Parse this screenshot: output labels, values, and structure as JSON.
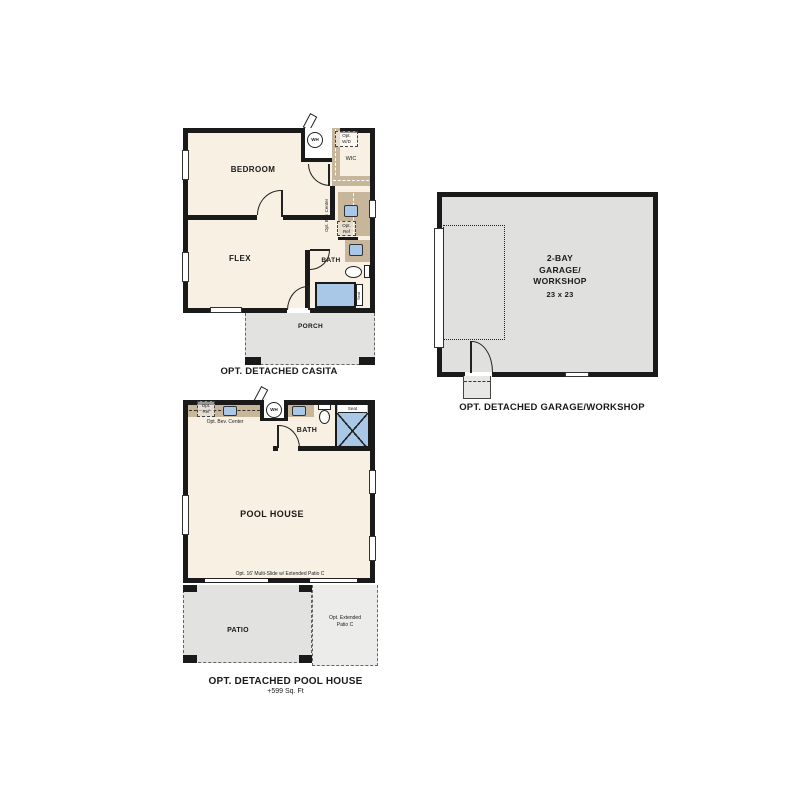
{
  "colors": {
    "wall": "#1a1a1a",
    "floor": "#f8f1e3",
    "counter_tan": "#c8b69a",
    "concrete_gray": "#e2e2e0",
    "fixture_blue": "#a9c8e7"
  },
  "casita": {
    "title": "OPT. DETACHED CASITA",
    "bedroom": "BEDROOM",
    "flex": "FLEX",
    "bath": "BATH",
    "wic": "WIC",
    "porch": "PORCH",
    "wh": "WH",
    "opt_wd_line1": "Opt.",
    "opt_wd_line2": "W/D",
    "opt_bev_center": "Opt. Bev. Center",
    "opt_ref_line1": "Opt.",
    "opt_ref_line2": "Ref",
    "seat": "Seat"
  },
  "garage": {
    "title": "OPT. DETACHED GARAGE/WORKSHOP",
    "name_line1": "2-BAY",
    "name_line2": "GARAGE/",
    "name_line3": "WORKSHOP",
    "dimensions": "23 x 23"
  },
  "pool_house": {
    "title": "OPT. DETACHED POOL HOUSE",
    "sqft": "+599 Sq. Ft",
    "room": "POOL HOUSE",
    "bath": "BATH",
    "patio": "PATIO",
    "wh": "WH",
    "opt_ref_line1": "Opt.",
    "opt_ref_line2": "Ref",
    "opt_bev_center": "Opt. Bev. Center",
    "seat": "Seat",
    "multi_slide": "Opt. 16' Multi-Slide w/ Extended Patio C",
    "ext_patio_line1": "Opt. Extended",
    "ext_patio_line2": "Patio C"
  }
}
